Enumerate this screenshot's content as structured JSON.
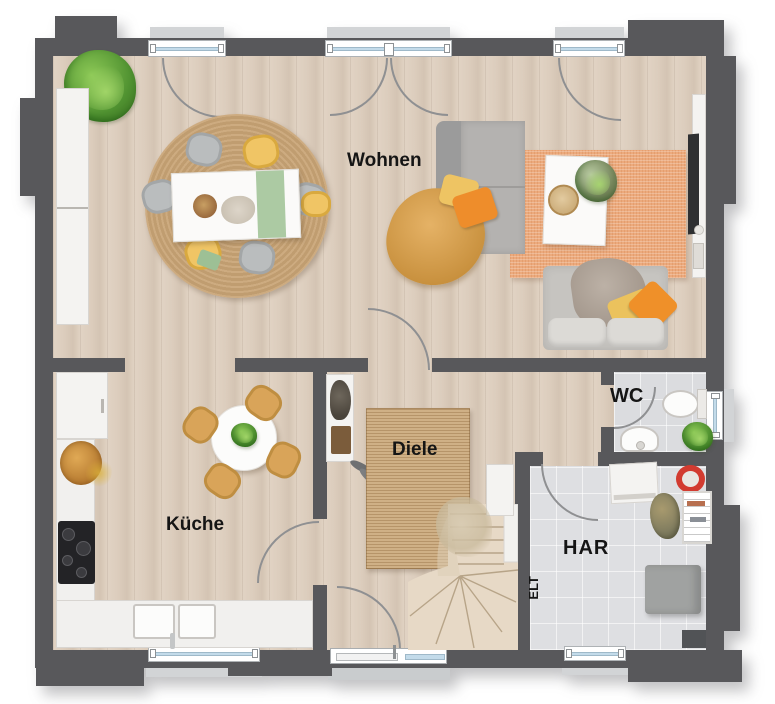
{
  "rooms": {
    "wohnen": "Wohnen",
    "kueche": "Küche",
    "diele": "Diele",
    "wc": "WC",
    "har": "HAR",
    "elt": "ELT"
  },
  "colors": {
    "wall": "#58585b",
    "floor_wood": "#dccdbd",
    "floor_tile": "#dbdcdf",
    "rug_jute": "#c8a77c",
    "rug_orange": "#ecaa7d",
    "accent_orange": "#ef9029",
    "accent_yellow": "#eec463",
    "window_glass": "#c3dbea",
    "sill": "#d2d4d6"
  }
}
